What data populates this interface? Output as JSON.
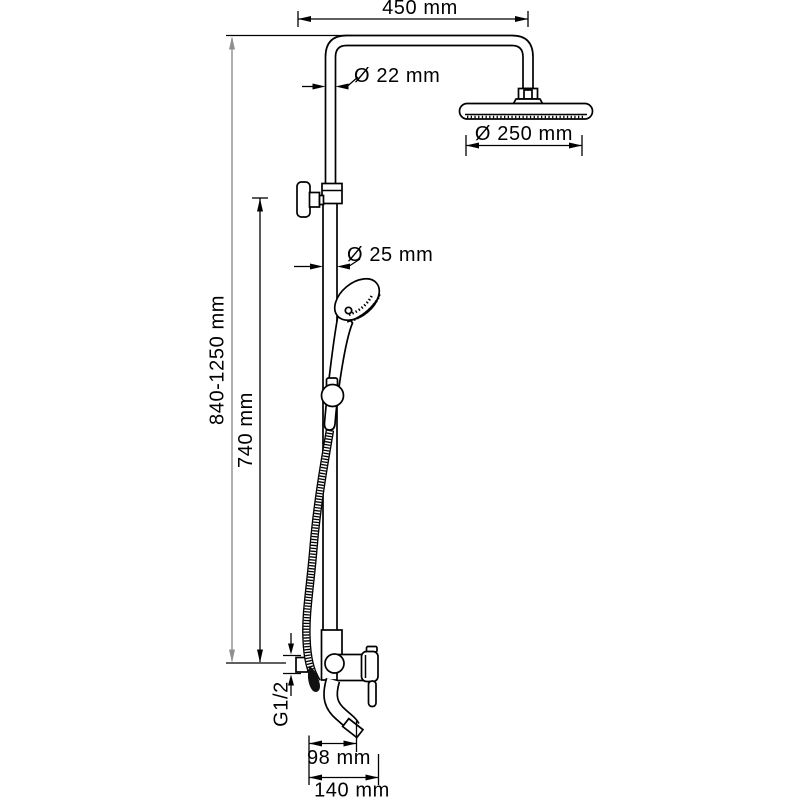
{
  "diagram": {
    "type": "technical-drawing",
    "subject": "shower-column-with-mixer",
    "background_color": "#ffffff",
    "line_color": "#000000",
    "secondary_dimension_color": "#8f8f8f",
    "dimensions": {
      "top_arm_width": "450 mm",
      "upper_pipe_diameter": "Ø 22 mm",
      "overhead_shower_diameter": "Ø 250 mm",
      "lower_pipe_diameter": "Ø 25 mm",
      "overall_height_range": "840-1250 mm",
      "bracket_height": "740 mm",
      "inlet_thread": "G1/2",
      "spout_reach": "98 mm",
      "handle_reach": "140 mm"
    }
  }
}
